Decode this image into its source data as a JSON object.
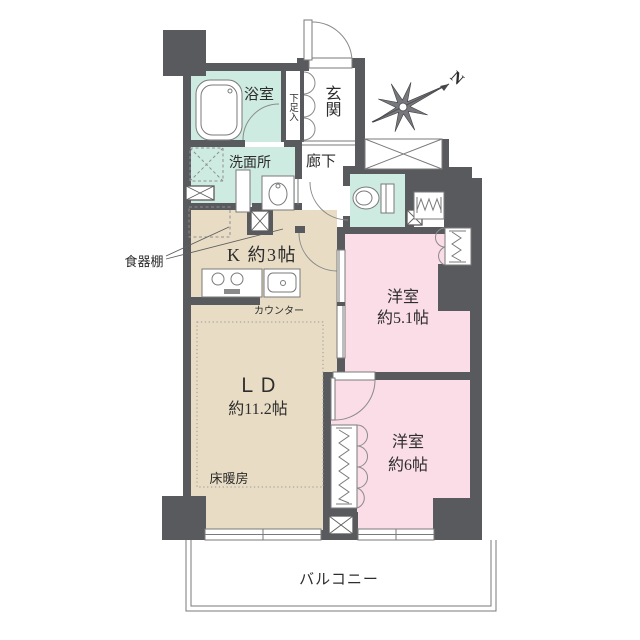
{
  "colors": {
    "wall": "#595a5e",
    "wet_room_fill": "#cdebe0",
    "kitchen_ld_fill": "#e8dcc4",
    "bedroom_fill": "#fadde6",
    "line": "#7a7a7a",
    "text": "#2d2d2d"
  },
  "labels": {
    "bathroom": "浴室",
    "shoe_cabinet": "下足入",
    "entrance": "玄関",
    "washroom": "洗面所",
    "hallway": "廊下",
    "kitchen": "K 約3帖",
    "dish_shelf": "食器棚",
    "counter": "カウンター",
    "living_dining": "ＬＤ",
    "living_dining_size": "約11.2帖",
    "floor_heating": "床暖房",
    "bedroom1": "洋室",
    "bedroom1_size": "約5.1帖",
    "bedroom2": "洋室",
    "bedroom2_size": "約6帖",
    "balcony": "バルコニー",
    "compass_north": "N"
  }
}
